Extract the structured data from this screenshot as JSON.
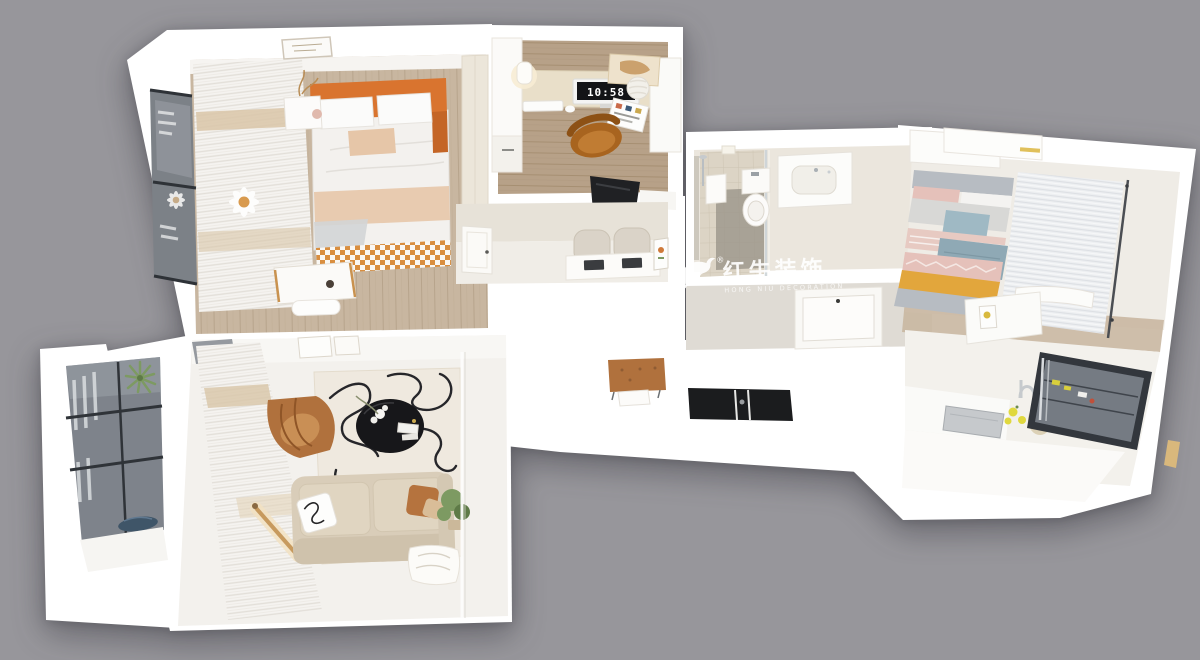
{
  "watermark": {
    "icon": "bull-logo-icon",
    "registered_mark": "®",
    "brand_cn": "红牛装饰",
    "brand_en": "HONG NIU DECORATION"
  },
  "study": {
    "monitor_time": "10:58"
  },
  "colors": {
    "background": "#97969b",
    "wall_white": "#ffffff",
    "floor_wood": "#c8b6a0",
    "floor_wood_dark": "#b7a188",
    "bed_headboard_orange": "#d9742f",
    "throw_beige": "#e8cbb0",
    "daisy_center_gold": "#d89a4e",
    "chair_leather": "#b0713d",
    "office_chair_orange": "#a8641f",
    "sofa_beige": "#d9cdb9",
    "coffee_table_black": "#17171a",
    "cooktop_black": "#1b1c1e",
    "tv_black": "#202124",
    "stripe_yellow": "#e2a63c",
    "stripe_blue": "#9fb9c4",
    "stripe_pink": "#e5c1ba",
    "stripe_gray": "#b7bcc2",
    "glass_gray": "#7e838b",
    "plant_green": "#7d9a62",
    "lemon_yellow": "#e0d83e"
  }
}
